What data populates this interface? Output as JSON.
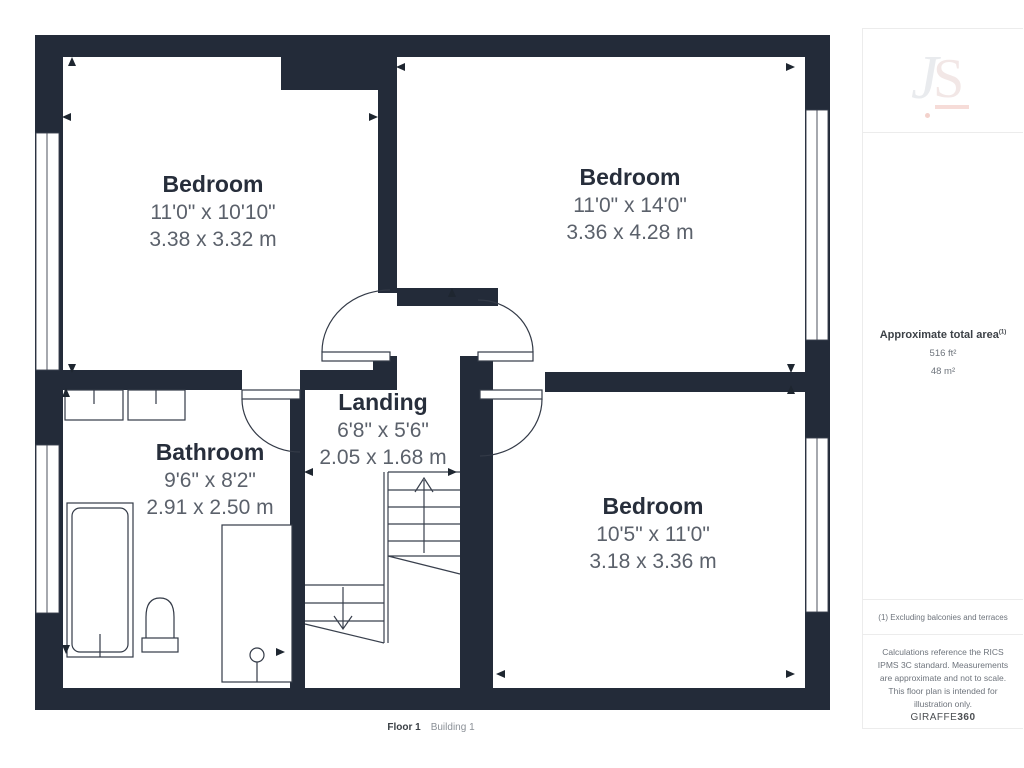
{
  "plan": {
    "wall_color": "#232b39",
    "rooms": [
      {
        "name": "Bedroom",
        "imperial": "11'0\" x 10'10\"",
        "metric": "3.38 x 3.32 m"
      },
      {
        "name": "Bedroom",
        "imperial": "11'0\" x 14'0\"",
        "metric": "3.36 x 4.28 m"
      },
      {
        "name": "Landing",
        "imperial": "6'8\" x 5'6\"",
        "metric": "2.05 x 1.68 m"
      },
      {
        "name": "Bathroom",
        "imperial": "9'6\" x 8'2\"",
        "metric": "2.91 x 2.50 m"
      },
      {
        "name": "Bedroom",
        "imperial": "10'5\" x 11'0\"",
        "metric": "3.18 x 3.36 m"
      }
    ],
    "footer": {
      "floor": "Floor 1",
      "building": "Building 1"
    }
  },
  "sidebar": {
    "logo_j": "J",
    "logo_s": "S",
    "logo_accent_color": "#f6dcd8",
    "area": {
      "title": "Approximate total area",
      "note_marker": "(1)",
      "imperial": "516 ft²",
      "metric": "48 m²"
    },
    "note": "(1) Excluding balconies and terraces",
    "disclaimer": "Calculations reference the RICS IPMS 3C standard. Measurements are approximate and not to scale. This floor plan is intended for illustration only.",
    "brand": {
      "name": "GIRAFFE",
      "suffix": "360"
    }
  }
}
